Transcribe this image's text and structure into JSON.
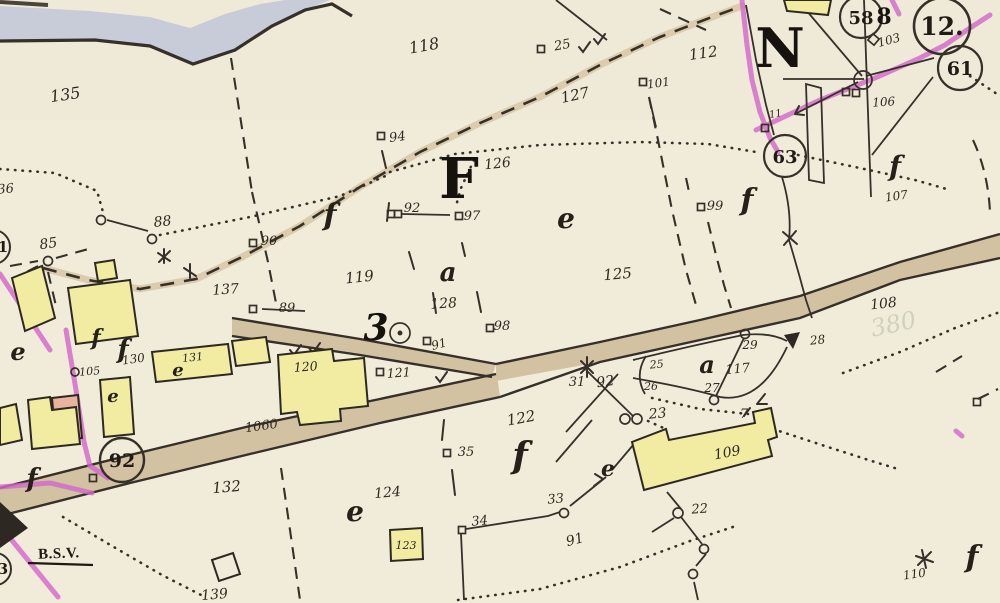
{
  "map": {
    "title": "plat-survey-map-sheet",
    "palette": {
      "paper": "#f1ecd9",
      "water_band": "#c8ccd9",
      "road_fill": "#d2c2a2",
      "trail_halo": "#dcccae",
      "building_yellow": "#f1eca1",
      "building_pink": "#e9b49e",
      "utility_magenta": "#d468cc",
      "ink": "#35302a"
    },
    "big_letters": {
      "F": "F",
      "N": "N",
      "three": "3"
    },
    "circled": {
      "c58": "58",
      "c12": "12.",
      "c61": "61",
      "c63": "63",
      "c92": "92",
      "c1": "1",
      "c3": "3"
    },
    "texts": {
      "bsv": "B.S.V.",
      "eight": "8",
      "eleven": "11",
      "bleed": "380"
    },
    "letters": {
      "f1": "f",
      "f2": "f",
      "f3": "f",
      "f4": "f",
      "f5": "f",
      "f6": "f",
      "f7": "f",
      "f8": "f",
      "e1": "e",
      "e2": "e",
      "e3": "e",
      "e4": "e",
      "e5": "e",
      "e6": "e",
      "a1": "a",
      "a2": "a"
    },
    "labels": {
      "n135": "135",
      "n118": "118",
      "n25top": "25",
      "n112": "112",
      "n101": "101",
      "n127": "127",
      "n94": "94",
      "n126": "126",
      "n103": "103",
      "n106ne": "106",
      "n92mk": "92",
      "n97": "97",
      "n99": "99",
      "n107": "107",
      "n88": "88",
      "n85": "85",
      "n90": "90",
      "n137": "137",
      "n119": "119",
      "n128": "128",
      "n98": "98",
      "n91mk": "91",
      "n125": "125",
      "n108": "108",
      "n105": "105",
      "n130": "130",
      "n131": "131",
      "n120": "120",
      "n121": "121",
      "n1060": "1060",
      "n132": "132",
      "n122": "122",
      "n124": "124",
      "n123": "123",
      "n35": "35",
      "n31": "31",
      "n92rd": "92",
      "n25fk": "25",
      "n26": "26",
      "n117": "117",
      "n27": "27",
      "n29": "29",
      "n28": "28",
      "n23": "23",
      "n7": "7",
      "n109": "109",
      "n33": "33",
      "n34": "34",
      "n91s": "91",
      "n22": "22",
      "n110": "110",
      "n139": "139",
      "n36": "36",
      "n89": "89"
    }
  }
}
